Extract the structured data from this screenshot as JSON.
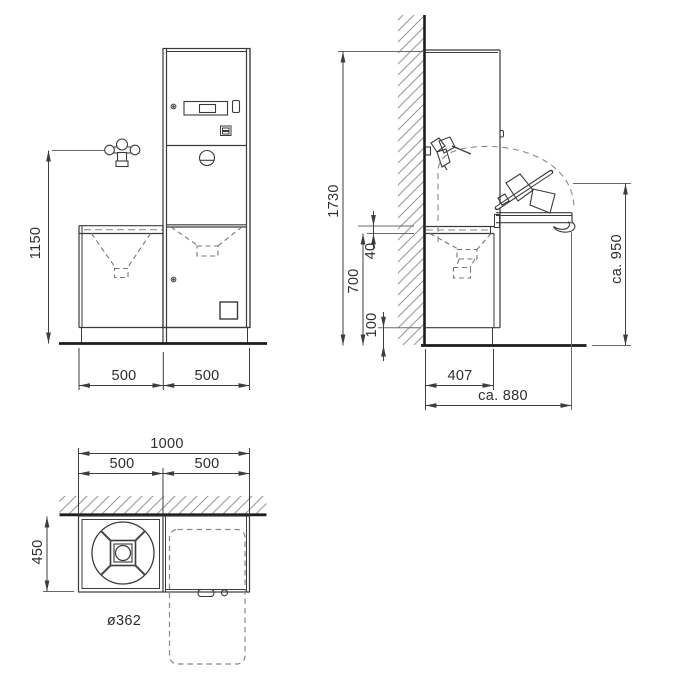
{
  "dims": {
    "front": {
      "faucet_height": "1150",
      "left_module_width": "500",
      "right_module_width": "500"
    },
    "side": {
      "overall_height": "1730",
      "worktop_height": "700",
      "table_offset": "40",
      "plinth_height": "100",
      "open_table_height": "ca. 950",
      "body_depth": "407",
      "open_depth": "ca. 880"
    },
    "top": {
      "overall_width": "1000",
      "left_module_width": "500",
      "right_module_width": "500",
      "depth": "450",
      "basin_diameter": "ø362"
    }
  },
  "colors": {
    "line": "#3a3a3a",
    "heavy_line": "#1c1c1c",
    "dashed": "#858585",
    "hatch": "#9a9a9a",
    "dimension": "#3d3d3d",
    "text": "#2e2e2e",
    "background": "#ffffff"
  }
}
